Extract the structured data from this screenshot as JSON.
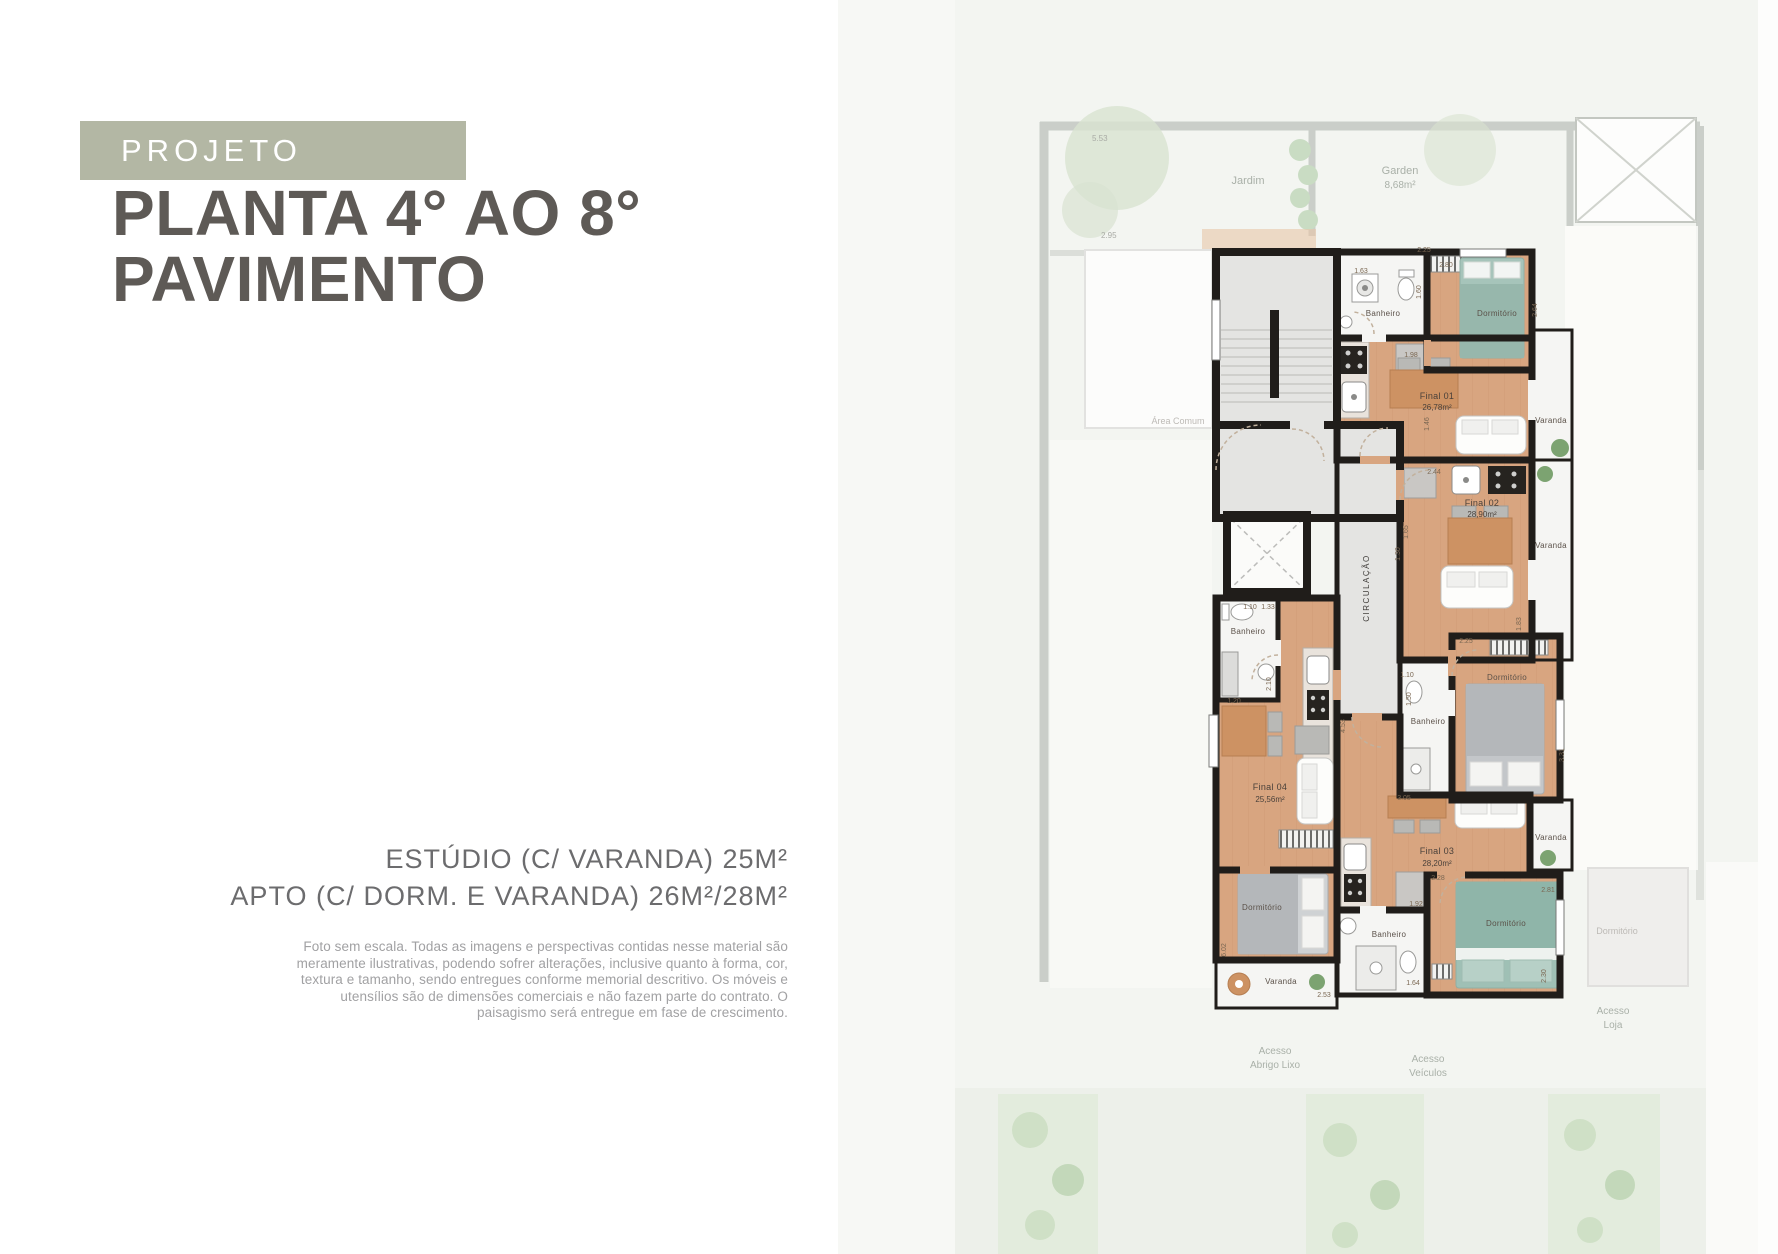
{
  "left_panel": {
    "badge": "PROJETO",
    "title_line1": "PLANTA 4° AO 8°",
    "title_line2": "PAVIMENTO",
    "spec_line1": "ESTÚDIO (C/ VARANDA) 25M²",
    "spec_line2": "APTO (C/ DORM. E VARANDA) 26M²/28M²",
    "disclaimer_lines": [
      "Foto sem escala. Todas as imagens e perspectivas contidas nesse material são",
      "meramente ilustrativas, podendo sofrer alterações, inclusive quanto à forma, cor,",
      "textura e tamanho, sendo entregues conforme memorial descritivo. Os móveis e",
      "utensílios são de dimensões comerciais e não fazem parte do contrato. O",
      "paisagismo será entregue em fase de crescimento."
    ]
  },
  "floor_plan": {
    "units": {
      "f1_name": "Final 01",
      "f1_area": "26,78m²",
      "f2_name": "Final 02",
      "f2_area": "28,90m²",
      "f3_name": "Final 03",
      "f3_area": "28,20m²",
      "f4_name": "Final 04",
      "f4_area": "25,56m²"
    },
    "labels": {
      "banheiro": "Banheiro",
      "dormitorio": "Dormitório",
      "varanda": "Varanda",
      "circulacao": "CIRCULAÇÃO"
    },
    "site": {
      "jardim": "Jardim",
      "garden": "Garden",
      "garden_area": "8,68m²",
      "area_comum": "Área Comum",
      "acesso": "Acesso",
      "abrigo_lixo": "Abrigo Lixo",
      "loja": "Loja",
      "veiculos": "Veículos",
      "dormitorio_faded": "Dormitório"
    },
    "dims": {
      "d1": "2.25",
      "d2": "2.80",
      "d3": "1.63",
      "d4": "1.60",
      "d5": "1.98",
      "d6": "2.64",
      "d7": "2.44",
      "d8": "1.46",
      "d9": "1.65",
      "d10": "1.30",
      "d11": "1.10",
      "d12": "1.33",
      "d13": "2.10",
      "d14": "1.20",
      "d15": "4.53",
      "d16": "1.10",
      "d17": "1.50",
      "d18": "2.25",
      "d19": "3.05",
      "d20": "2.28",
      "d21": "1.92",
      "d22": "2.81",
      "d23": "1.64",
      "d24": "6.02",
      "d25": "2.53",
      "d26": "2.30",
      "d27": "1.83",
      "d28": "3.31",
      "d29": "5.53",
      "d30": "2.95"
    }
  },
  "colors": {
    "badge_bg": "#b3b7a4",
    "heading": "#5e5a56",
    "spec_text": "#6c6c6e",
    "disclaimer_text": "#a1a1a3",
    "wall": "#201d1a",
    "wood_floor": "#d8a580",
    "teal_bed": "#a3c2b8",
    "gray_floor": "#e4e4e2",
    "site_bg": "#f3f5f1",
    "site_green": "#d8e3d1"
  }
}
